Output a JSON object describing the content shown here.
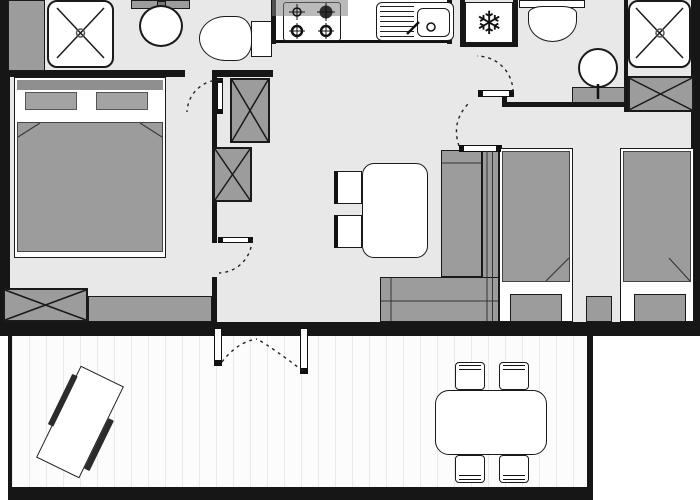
{
  "title": "Mobile home floor plan with deck",
  "colors": {
    "wall": "#161616",
    "floor": "#e8e8e8",
    "furn": "#9c9c9c",
    "furn-dark": "#2b2b2b",
    "outline": "#1a1a1a",
    "deck-bg": "#fcfcfc",
    "deck-line": "#e9e9e9",
    "white": "#ffffff"
  },
  "fixtures": {
    "fridge_symbol": "❄",
    "inventory": [
      "shower-left",
      "water-heater-cabinet",
      "vanity-basin-left",
      "toilet-left",
      "cooktop-4-burners",
      "kitchen-sink-with-drainboard",
      "refrigerator",
      "toilet-right",
      "wash-basin-right",
      "shower-right",
      "wardrobe-right",
      "wardrobe-mid-upper",
      "wardrobe-mid-lower",
      "double-bed-with-pillows",
      "storage-chest",
      "bench-seat",
      "dining-table-indoor",
      "chairs-indoor",
      "l-shaped-sofa",
      "twin-bed-left",
      "twin-bed-right",
      "nightstand",
      "french-double-door",
      "interior-doors-with-swing-arcs",
      "deck-picnic-table",
      "deck-dining-table-with-4-chairs",
      "deck-planking"
    ]
  }
}
